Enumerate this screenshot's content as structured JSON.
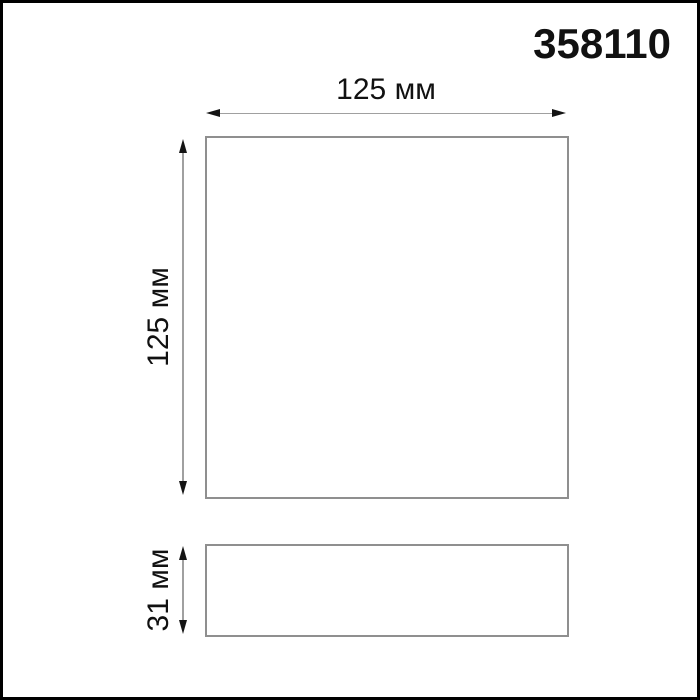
{
  "product": {
    "code": "358110"
  },
  "dimensions": {
    "width_label": "125 мм",
    "height_label": "125 мм",
    "depth_label": "31 мм"
  },
  "colors": {
    "background": "#ffffff",
    "frame": "#000000",
    "outline": "#8f8f8f",
    "dimline": "#a0a0a0",
    "arrowhead": "#141414",
    "text": "#111111"
  }
}
